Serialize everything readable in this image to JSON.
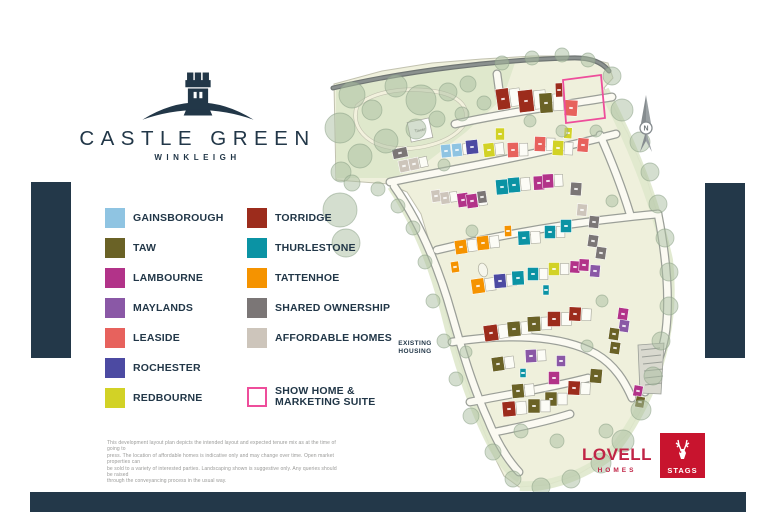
{
  "brand": {
    "name": "CASTLE GREEN",
    "location": "WINKLEIGH"
  },
  "legend": {
    "column1": [
      {
        "label": "GAINSBOROUGH",
        "color": "#8fc4e2"
      },
      {
        "label": "TAW",
        "color": "#6a6226"
      },
      {
        "label": "LAMBOURNE",
        "color": "#b23389"
      },
      {
        "label": "MAYLANDS",
        "color": "#8a58a6"
      },
      {
        "label": "LEASIDE",
        "color": "#e7625d"
      },
      {
        "label": "ROCHESTER",
        "color": "#4c4aa2"
      },
      {
        "label": "REDBOURNE",
        "color": "#d2d226"
      }
    ],
    "column2": [
      {
        "label": "TORRIDGE",
        "color": "#9c2c1c"
      },
      {
        "label": "THURLESTONE",
        "color": "#0b93a4"
      },
      {
        "label": "TATTENHOE",
        "color": "#f59300"
      },
      {
        "label": "SHARED OWNERSHIP",
        "color": "#7b7676"
      },
      {
        "label": "AFFORDABLE HOMES",
        "color": "#cdc5bb"
      }
    ],
    "show_home": {
      "line1": "SHOW HOME &",
      "line2": "MARKETING SUITE",
      "border_color": "#ee4d9b"
    }
  },
  "disclaimer": {
    "lines": [
      "This development layout plan depicts the intended layout and expected tenure mix as at the time of going to",
      "press. The location of affordable homes is indicative only and may change over time. Open market properties can",
      "be sold to a variety of interested parties. Landscaping shown is suggestive only. Any queries should be raised",
      "through the conveyancing process in the usual way."
    ]
  },
  "map": {
    "existing_housing_line1": "EXISTING",
    "existing_housing_line2": "HOUSING",
    "north_label": "N",
    "tower_label": "Tower",
    "colors": {
      "site": "#eff0dc",
      "landscape": "#dfe8cc",
      "tree": "#a9bda0",
      "tree_edge": "#8aa186",
      "road_fill": "#fbfaf2",
      "road_edge": "#9b9f98",
      "top_road": "#6f7573",
      "show_home_outline": "#ee4d9b",
      "navy": "#223748",
      "types": {
        "gainsborough": "#8fc4e2",
        "taw": "#6a6226",
        "lambourne": "#b23389",
        "maylands": "#8a58a6",
        "leaside": "#e7625d",
        "rochester": "#4c4aa2",
        "redbourne": "#d2d226",
        "torridge": "#9c2c1c",
        "thurlestone": "#0b93a4",
        "tattenhoe": "#f59300",
        "shared": "#7b7676",
        "affordable": "#cdc5bb"
      }
    },
    "site_outline": "M334,84 L382,71 L432,63 L482,59 L532,56 L577,56 L608,63 L613,78 L604,88 L628,134 L646,176 L658,216 L666,256 L671,296 L669,331 L659,366 L646,401 L628,433 L604,459 L577,475 L547,485 L519,487 L504,476 L493,454 L481,424 L469,391 L457,354 L447,317 L439,281 L431,247 L421,214 L407,192 L389,184 L336,180 Z",
    "landscape_area": "M336,84 L478,62 L516,60 L503,98 L466,132 L427,162 L393,178 L336,178 Z",
    "verges": [
      "M604,90 C630,140 655,200 668,260 C676,330 655,400 610,455 C580,478 545,488 520,486",
      "M392,186 C415,220 432,260 445,310 C456,355 470,400 490,440 C500,460 510,472 520,478"
    ],
    "loop_path": "M357,106 C372,92 402,87 432,91 C462,95 472,110 463,126 C450,143 418,151 393,148 C368,145 350,128 357,106 Z",
    "top_road": "M333,88 C410,70 500,60 570,58 C590,57 602,62 609,71",
    "roads": [
      "M497,74 L500,96",
      "M455,124 C500,114 555,106 612,97",
      "M390,182 C450,170 530,156 616,134",
      "M437,250 C495,236 570,222 658,214",
      "M452,342 C505,334 560,334 596,354 C615,365 625,382 632,398",
      "M470,402 C510,394 550,388 588,378",
      "M495,432 C520,427 548,421 570,414",
      "M658,214 C666,255 670,295 666,330 C663,352 655,372 645,392",
      "M394,186 C418,220 438,265 452,315 C462,350 472,385 488,420 C496,440 506,458 519,472",
      "M600,135 C612,162 622,188 630,214"
    ],
    "pond": {
      "cx": 483,
      "cy": 270,
      "rx": 4.5,
      "ry": 7
    },
    "tower": {
      "x": 420,
      "y": 130,
      "w": 22,
      "h": 20,
      "a": -12
    },
    "parking_strip": "M638,345 L664,343 L661,394 L640,393 Z",
    "parking_rungs": [
      [
        641,
        350,
        660,
        348
      ],
      [
        642,
        357,
        661,
        355
      ],
      [
        643,
        364,
        662,
        362
      ],
      [
        644,
        371,
        663,
        369
      ],
      [
        645,
        378,
        663,
        376
      ],
      [
        645,
        385,
        662,
        383
      ]
    ],
    "show_home_outline": "563,80 601,75 605,118 566,123",
    "trees": [
      [
        352,
        95,
        13
      ],
      [
        340,
        128,
        15
      ],
      [
        372,
        110,
        10
      ],
      [
        396,
        86,
        11
      ],
      [
        421,
        100,
        15
      ],
      [
        448,
        92,
        9
      ],
      [
        468,
        84,
        8
      ],
      [
        416,
        129,
        10
      ],
      [
        386,
        141,
        12
      ],
      [
        360,
        156,
        12
      ],
      [
        341,
        172,
        10
      ],
      [
        437,
        119,
        8
      ],
      [
        462,
        114,
        7
      ],
      [
        484,
        103,
        7
      ],
      [
        502,
        63,
        7
      ],
      [
        532,
        58,
        7
      ],
      [
        562,
        55,
        7
      ],
      [
        588,
        60,
        7
      ],
      [
        612,
        76,
        9
      ],
      [
        622,
        110,
        11
      ],
      [
        640,
        142,
        10
      ],
      [
        650,
        172,
        9
      ],
      [
        658,
        204,
        9
      ],
      [
        665,
        238,
        9
      ],
      [
        669,
        272,
        9
      ],
      [
        669,
        306,
        9
      ],
      [
        661,
        341,
        9
      ],
      [
        653,
        376,
        9
      ],
      [
        641,
        410,
        10
      ],
      [
        623,
        441,
        11
      ],
      [
        601,
        463,
        10
      ],
      [
        571,
        479,
        9
      ],
      [
        541,
        487,
        9
      ],
      [
        513,
        479,
        8
      ],
      [
        493,
        452,
        8
      ],
      [
        471,
        416,
        8
      ],
      [
        456,
        379,
        7
      ],
      [
        444,
        341,
        7
      ],
      [
        433,
        301,
        7
      ],
      [
        425,
        262,
        7
      ],
      [
        413,
        228,
        7
      ],
      [
        398,
        206,
        7
      ],
      [
        378,
        189,
        7
      ],
      [
        352,
        183,
        8
      ],
      [
        340,
        210,
        17
      ],
      [
        346,
        243,
        14
      ],
      [
        444,
        165,
        6
      ],
      [
        530,
        121,
        6
      ],
      [
        562,
        131,
        6
      ],
      [
        596,
        131,
        6
      ],
      [
        612,
        201,
        6
      ],
      [
        472,
        231,
        6
      ],
      [
        602,
        301,
        6
      ],
      [
        466,
        352,
        6
      ],
      [
        587,
        346,
        6
      ],
      [
        521,
        431,
        7
      ],
      [
        557,
        441,
        7
      ],
      [
        606,
        431,
        7
      ]
    ],
    "houses": [
      [
        503,
        99,
        13,
        21,
        -8,
        "torridge",
        1
      ],
      [
        526,
        101,
        15,
        22,
        -6,
        "torridge",
        1
      ],
      [
        546,
        103,
        13,
        20,
        -4,
        "taw",
        1
      ],
      [
        559,
        90,
        7,
        14,
        -2,
        "torridge",
        0
      ],
      [
        571,
        108,
        13,
        16,
        4,
        "leaside",
        0
      ],
      [
        500,
        134,
        9,
        12,
        0,
        "redbourne",
        0
      ],
      [
        513,
        150,
        11,
        15,
        -2,
        "leaside",
        1
      ],
      [
        540,
        144,
        11,
        15,
        2,
        "leaside",
        1
      ],
      [
        558,
        148,
        11,
        15,
        3,
        "redbourne",
        1
      ],
      [
        568,
        133,
        8,
        11,
        3,
        "redbourne",
        0
      ],
      [
        583,
        145,
        11,
        14,
        5,
        "leaside",
        0
      ],
      [
        446,
        151,
        10,
        13,
        -6,
        "gainsborough",
        0
      ],
      [
        457,
        150,
        10,
        13,
        -6,
        "gainsborough",
        1
      ],
      [
        472,
        147,
        12,
        14,
        -6,
        "rochester",
        0
      ],
      [
        489,
        150,
        11,
        14,
        -6,
        "redbourne",
        1
      ],
      [
        400,
        153,
        15,
        10,
        -12,
        "shared",
        0
      ],
      [
        404,
        166,
        10,
        12,
        -12,
        "affordable",
        0
      ],
      [
        414,
        164,
        10,
        12,
        -12,
        "affordable",
        1
      ],
      [
        436,
        196,
        9,
        12,
        -8,
        "affordable",
        0
      ],
      [
        445,
        198,
        9,
        12,
        -8,
        "affordable",
        1
      ],
      [
        463,
        200,
        11,
        14,
        -8,
        "lambourne",
        0
      ],
      [
        472,
        201,
        11,
        14,
        -8,
        "lambourne",
        1
      ],
      [
        482,
        197,
        9,
        12,
        -8,
        "shared",
        0
      ],
      [
        502,
        187,
        12,
        15,
        -5,
        "thurlestone",
        1
      ],
      [
        514,
        185,
        12,
        15,
        -5,
        "thurlestone",
        1
      ],
      [
        539,
        183,
        11,
        14,
        -3,
        "lambourne",
        0
      ],
      [
        548,
        181,
        11,
        14,
        -3,
        "lambourne",
        1
      ],
      [
        576,
        189,
        11,
        13,
        4,
        "shared",
        0
      ],
      [
        582,
        210,
        10,
        12,
        5,
        "affordable",
        0
      ],
      [
        594,
        222,
        10,
        12,
        6,
        "shared",
        0
      ],
      [
        461,
        247,
        12,
        14,
        -8,
        "tattenhoe",
        1
      ],
      [
        483,
        243,
        12,
        14,
        -6,
        "tattenhoe",
        1
      ],
      [
        508,
        231,
        7,
        11,
        -2,
        "tattenhoe",
        0
      ],
      [
        524,
        238,
        12,
        14,
        -3,
        "thurlestone",
        1
      ],
      [
        550,
        232,
        11,
        13,
        0,
        "thurlestone",
        1
      ],
      [
        566,
        226,
        11,
        13,
        0,
        "thurlestone",
        0
      ],
      [
        593,
        241,
        10,
        12,
        8,
        "shared",
        0
      ],
      [
        601,
        253,
        10,
        12,
        8,
        "shared",
        0
      ],
      [
        455,
        267,
        8,
        11,
        -8,
        "tattenhoe",
        0
      ],
      [
        478,
        286,
        13,
        15,
        -8,
        "tattenhoe",
        1
      ],
      [
        500,
        281,
        12,
        14,
        -5,
        "rochester",
        1
      ],
      [
        518,
        278,
        12,
        14,
        -3,
        "thurlestone",
        0
      ],
      [
        533,
        274,
        11,
        13,
        0,
        "thurlestone",
        1
      ],
      [
        554,
        269,
        11,
        13,
        0,
        "redbourne",
        1
      ],
      [
        575,
        267,
        10,
        12,
        3,
        "lambourne",
        0
      ],
      [
        584,
        265,
        10,
        12,
        3,
        "lambourne",
        0
      ],
      [
        595,
        271,
        10,
        12,
        5,
        "maylands",
        0
      ],
      [
        546,
        290,
        6,
        10,
        0,
        "thurlestone",
        0
      ],
      [
        623,
        314,
        10,
        12,
        8,
        "lambourne",
        0
      ],
      [
        624,
        326,
        10,
        12,
        8,
        "maylands",
        0
      ],
      [
        491,
        333,
        14,
        16,
        -8,
        "torridge",
        1
      ],
      [
        514,
        329,
        13,
        15,
        -5,
        "taw",
        1
      ],
      [
        534,
        324,
        13,
        15,
        -3,
        "taw",
        1
      ],
      [
        554,
        319,
        13,
        15,
        0,
        "torridge",
        1
      ],
      [
        575,
        314,
        12,
        14,
        3,
        "torridge",
        1
      ],
      [
        614,
        334,
        10,
        12,
        8,
        "taw",
        0
      ],
      [
        615,
        348,
        10,
        12,
        8,
        "taw",
        0
      ],
      [
        498,
        364,
        12,
        14,
        -8,
        "taw",
        1
      ],
      [
        531,
        356,
        11,
        13,
        -3,
        "maylands",
        1
      ],
      [
        561,
        361,
        9,
        11,
        0,
        "maylands",
        0
      ],
      [
        523,
        373,
        6,
        9,
        0,
        "thurlestone",
        0
      ],
      [
        638,
        391,
        9,
        11,
        10,
        "lambourne",
        0
      ],
      [
        640,
        402,
        9,
        11,
        10,
        "taw",
        0
      ],
      [
        518,
        391,
        12,
        14,
        -5,
        "taw",
        1
      ],
      [
        554,
        378,
        11,
        13,
        0,
        "lambourne",
        0
      ],
      [
        551,
        399,
        12,
        14,
        0,
        "taw",
        1
      ],
      [
        574,
        388,
        12,
        14,
        3,
        "torridge",
        1
      ],
      [
        596,
        376,
        12,
        14,
        5,
        "taw",
        0
      ],
      [
        509,
        409,
        13,
        15,
        -5,
        "torridge",
        1
      ],
      [
        534,
        406,
        12,
        14,
        0,
        "taw",
        1
      ]
    ]
  },
  "footer": {
    "lovell_name": "LOVELL",
    "lovell_sub": "HOMES",
    "stags_name": "STAGS",
    "lovell_color": "#c02446",
    "stags_bg": "#c8142e"
  },
  "chrome": {
    "bar_color": "#233849"
  }
}
